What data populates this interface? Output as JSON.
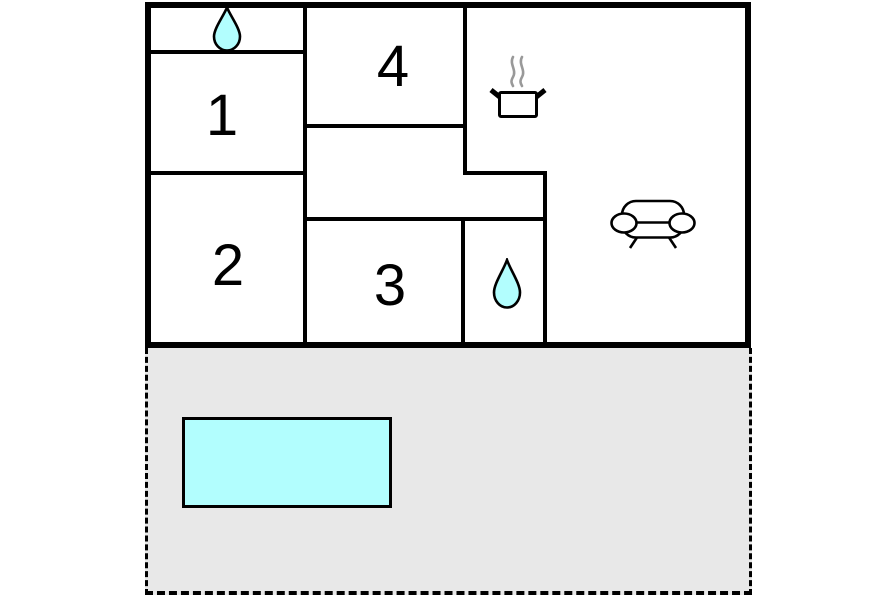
{
  "title": "Holiday home floor plan",
  "rooms": [
    {
      "label": "1"
    },
    {
      "label": "2"
    },
    {
      "label": "3"
    },
    {
      "label": "4"
    }
  ],
  "icons": {
    "drop_top": "water-drop",
    "drop_bath": "water-drop",
    "pot": "cooking-pot",
    "sofa": "sofa"
  },
  "colors": {
    "water": "#b2fefe",
    "terrace": "#e8e8e8",
    "wall": "#000000",
    "steam": "#999999",
    "background": "#ffffff"
  }
}
